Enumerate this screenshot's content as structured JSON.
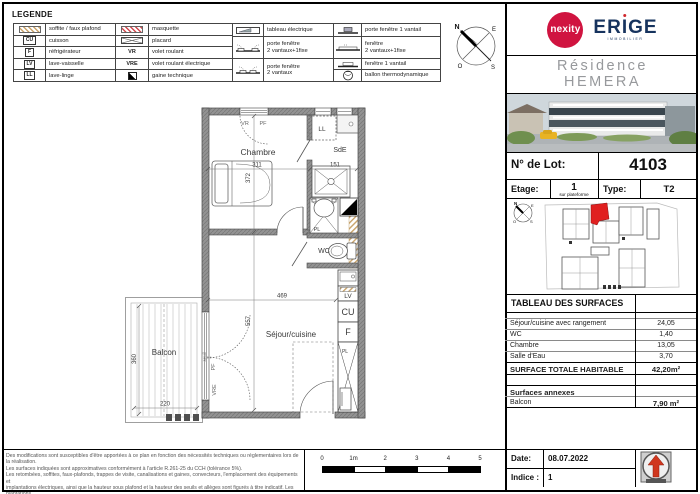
{
  "colors": {
    "brand_red": "#d01440",
    "brand_navy": "#16335e",
    "wall_gray": "#8f8f8f",
    "hatch_beige": "#c9a36a",
    "unit_red": "#e02020"
  },
  "legend": {
    "title": "LEGENDE",
    "col1": [
      {
        "label": "soffite / faux plafond"
      },
      {
        "icon_text": "CU",
        "label": "cuisson"
      },
      {
        "icon_text": "F",
        "label": "réfrigérateur"
      },
      {
        "icon_text": "LV",
        "label": "lave-vaisselle"
      },
      {
        "icon_text": "LL",
        "label": "lave-linge"
      }
    ],
    "col2": [
      {
        "label": "masquette"
      },
      {
        "label": "placard"
      },
      {
        "icon_text": "VR",
        "label": "volet roulant"
      },
      {
        "icon_text": "VRE",
        "label": "volet roulant électrique"
      },
      {
        "label": "gaine technique"
      }
    ],
    "col3": [
      {
        "label": "tableau électrique"
      },
      {
        "label": "porte fenêtre\n2 vantaux+1fixe"
      },
      {
        "label": "porte fenêtre\n2 vantaux"
      }
    ],
    "col4": [
      {
        "label": "porte fenêtre 1 vantail"
      },
      {
        "label": "fenêtre\n2 vantaux+1fixe"
      },
      {
        "label": "fenêtre 1 vantail"
      },
      {
        "label": "ballon thermodynamique"
      }
    ]
  },
  "compass": {
    "n": "N",
    "e": "E",
    "o": "O",
    "s": "S"
  },
  "plan": {
    "rooms": {
      "chambre": {
        "label": "Chambre",
        "dim_w": "311",
        "dim_h": "372"
      },
      "sde": {
        "label": "SdE",
        "dim": "151"
      },
      "wc": {
        "label": "WC"
      },
      "sejour": {
        "label": "Séjour/cuisine",
        "dim_w": "469",
        "dim_h": "557"
      },
      "balcon": {
        "label": "Balcon",
        "dim_w": "220",
        "dim_h": "360"
      }
    },
    "tags": {
      "vr": "VR",
      "pf": "PF",
      "ll": "LL",
      "pl": "PL",
      "lv": "LV",
      "cu": "CU",
      "f": "F",
      "vre": "VRE",
      "seuil": "seuil"
    }
  },
  "titleblock": {
    "brand1": "nexity",
    "brand2_left": "ER",
    "brand2_i": "I",
    "brand2_right": "GE",
    "brand2_sub": "IMMOBILIER",
    "residence_line1": "Résidence",
    "residence_line2": "HEMERA",
    "lot_label": "N° de Lot:",
    "lot_value": "4103",
    "etage_label": "Etage:",
    "etage_value": "1",
    "etage_note": "sur plateforme",
    "type_label": "Type:",
    "type_value": "T2",
    "surfaces_title": "TABLEAU DES SURFACES",
    "rows": [
      {
        "label": "Séjour/cuisine avec rangement",
        "value": "24,05"
      },
      {
        "label": "WC",
        "value": "1,40"
      },
      {
        "label": "Chambre",
        "value": "13,05"
      },
      {
        "label": "Salle d'Eau",
        "value": "3,70"
      }
    ],
    "total_label": "SURFACE TOTALE HABITABLE",
    "total_value": "42,20m²",
    "annexes_label": "Surfaces annexes",
    "annexe_rows": [
      {
        "label": "Balcon",
        "value": "7,90 m²"
      }
    ],
    "date_label": "Date:",
    "date_value": "08.07.2022",
    "indice_label": "Indice :",
    "indice_value": "1"
  },
  "scalebar": {
    "ticks": [
      "0",
      "1m",
      "2",
      "3",
      "4",
      "5"
    ]
  },
  "disclaimer": {
    "lines": [
      "Des modifications sont susceptibles d'être apportées à ce plan en fonction des nécessités techniques ou réglementaires lors de la réalisation.",
      "Les surfaces indiquées sont approximatives conformément à l'article R.261-25 du CCH (tolérance 5%).",
      "Les retombées, soffites, faux-plafonds, trappes de visite, canalisations et gaines, convecteurs, l'emplacement des équipements et",
      "implantations électriques, ainsi que la hauteur sous plafond et la hauteur des seuils et allèges sont figurés à titre indicatif. Les plantations",
      "éventuelles ne sont pas contractuelles. L'équipement électroménager et mobilier éventuellement indiqué sur le plan n'est pas fourni."
    ]
  }
}
